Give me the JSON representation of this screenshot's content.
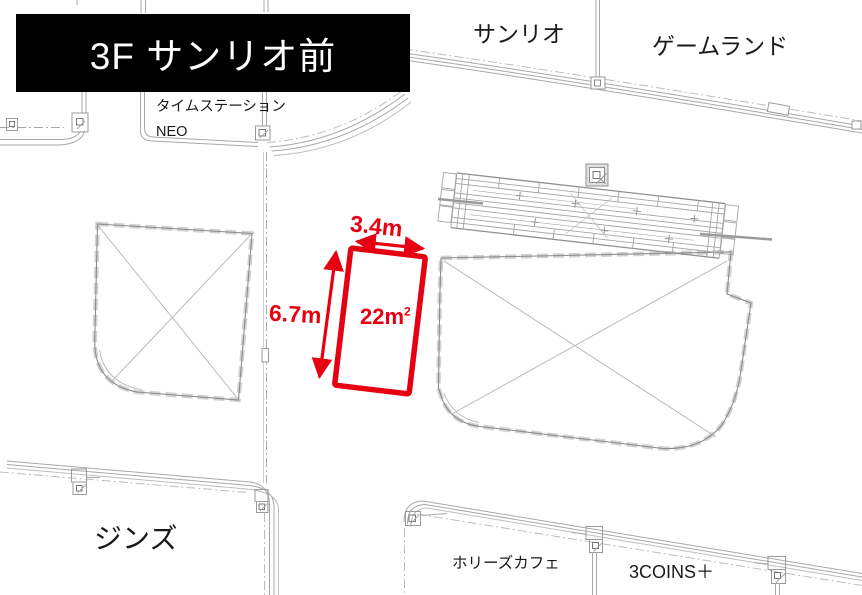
{
  "banner": {
    "label": "3F サンリオ前"
  },
  "stores": {
    "sanrio": "サンリオ",
    "gameland": "ゲームランド",
    "time_station_neo_line1": "タイムステーション",
    "time_station_neo_line2": "NEO",
    "jins": "ジンズ",
    "hollys_cafe": "ホリーズカフェ",
    "three_coins": "3COINS＋"
  },
  "vacancy": {
    "width": "3.4m",
    "depth": "6.7m",
    "area_value": "22",
    "area_unit": "m",
    "area_exponent": "2",
    "highlight_color": "#e60012"
  }
}
